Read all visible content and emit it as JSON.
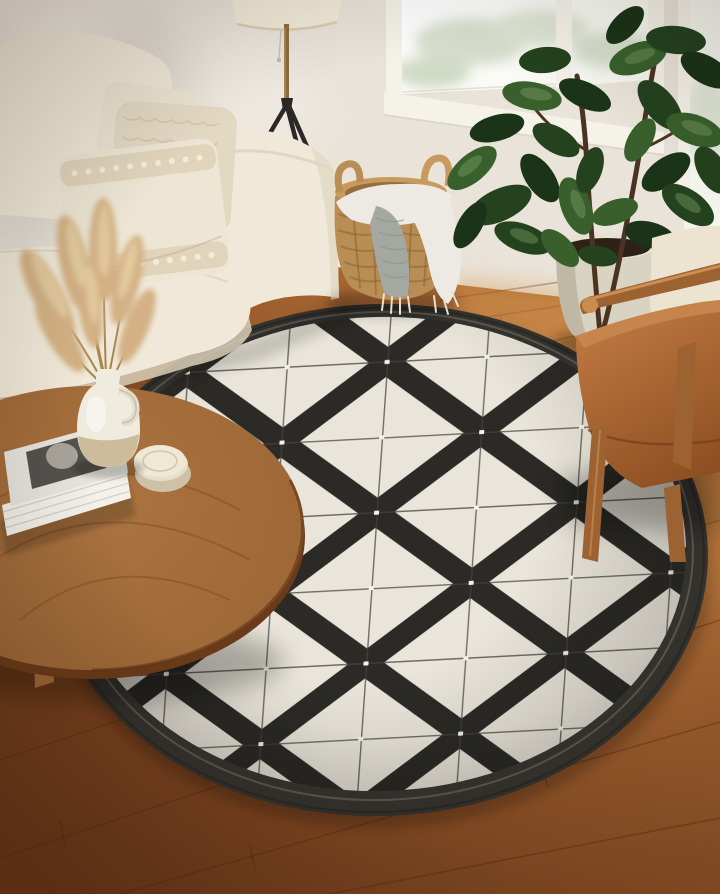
{
  "palette": {
    "wall": "#e9e3da",
    "wall_shadow": "#c9c0b1",
    "wall_light": "#f7f2ea",
    "baseboard": "#f2ede3",
    "window_frame": "#f5f2ea",
    "glass": "#f6f7ef",
    "glass_green": "#ccd6bf",
    "floor_light": "#bd7a3e",
    "floor_mid": "#96582a",
    "floor_dark": "#693517",
    "plank_line": "#52290f",
    "rug_white": "#e9e5da",
    "rug_black": "#2b2a26",
    "rug_border": "#34322d",
    "rug_line": "#45423a",
    "rug_dot": "#f4f2ea",
    "sofa": "#f0e9d9",
    "sofa_shade": "#d9cfb8",
    "pillow_smooth": "#ece4d1",
    "pillow_knit": "#e3d9c3",
    "pillow_front": "#eee6d4",
    "pampas": "#d3b184",
    "pampas_light": "#e8d1a6",
    "pampas_stem": "#a8854f",
    "vase_top": "#f0ebdf",
    "vase_bottom": "#cdbb9c",
    "table_wood": "#9c6535",
    "table_wood_dark": "#6b3b19",
    "book_cover": "#e8e5de",
    "book_photo": "#54524d",
    "book_pages": "#f4f1ea",
    "coaster": "#e7dfca",
    "basket": "#b98e55",
    "basket_dark": "#8a6233",
    "throw_white": "#eceae2",
    "throw_gray": "#a4a8a1",
    "lamp_shade": "#f2ead7",
    "lamp_stem": "#8d6b40",
    "lamp_leg": "#2a2927",
    "leaf_dark": "#24421e",
    "leaf_mid": "#39602c",
    "leaf_deep": "#1b3417",
    "leaf_light": "#7fa36b",
    "trunk": "#4b3322",
    "pot": "#d9d3c1",
    "soil": "#2e2218",
    "leather": "#b06c38",
    "leather_dark": "#8a4c20",
    "chair_wood": "#9c6231",
    "chair_wood_light": "#c98c4f",
    "shadow": "#1d1209"
  },
  "objects": {
    "scene": "living room with round black and white geometric rug",
    "wall": "warm white wall with soft daylight shadows",
    "window": "white framed window with daylight",
    "baseboard": "white baseboard trim",
    "floor": "warm brown hardwood plank floor",
    "rug": "round black and white diamond lattice rug with charcoal border",
    "sofa": "cream upholstered sofa",
    "pillows": "textured cream and knit throw pillows",
    "lamp": "tripod floor lamp with cream drum shade",
    "basket": "woven seagrass basket",
    "throw": "gray and white fringed throw blanket",
    "plant": "fiddle leaf fig plant",
    "pot": "cream ceramic planter",
    "table": "round walnut coffee table",
    "vase": "cream ceramic jug vase",
    "pampas": "dried pampas grass stems",
    "books": "stack of coffee table books",
    "coasters": "round stone coasters",
    "chair": "cognac leather armchair with wood frame"
  }
}
